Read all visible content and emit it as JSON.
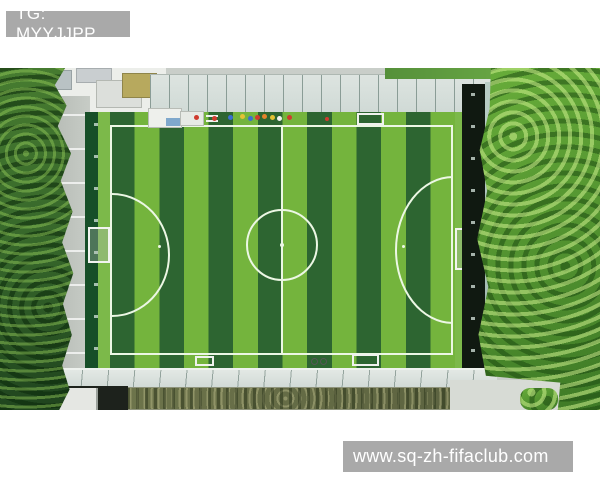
{
  "watermarks": {
    "top_left": "TG: MYYJJPP",
    "bottom_right": "www.sq-zh-fifaclub.com"
  },
  "scene": {
    "subject": "aerial drone view of rooftop artificial-turf football pitch",
    "pitch_stripes": 14,
    "stripe_orientation": "vertical"
  },
  "colors": {
    "page_bg": "#ffffff",
    "watermark_bg": "#a9a9a9",
    "watermark_text": "#ffffff",
    "turf_light": "#74b43d",
    "turf_dark": "#2d6531",
    "turf_buffer": "#7cb94a",
    "field_line": "#ecf7e4",
    "fence_dark": "#174f28",
    "fence_shadow": "#101911",
    "walkway": "#c7ccc6",
    "canopy": "#cfd9d5",
    "roof_white": "#eceeea",
    "roof_tan": "#b7a95e",
    "tree_bright": "#68ad3a",
    "tree_bright_dark": "#3e7a26",
    "tree_dark": "#477c30",
    "tree_darkest": "#1e421d",
    "track_red": "#9c5247",
    "court_teal": "#67a291",
    "planter": "#6d744b",
    "concrete": "#d7dbd5"
  }
}
